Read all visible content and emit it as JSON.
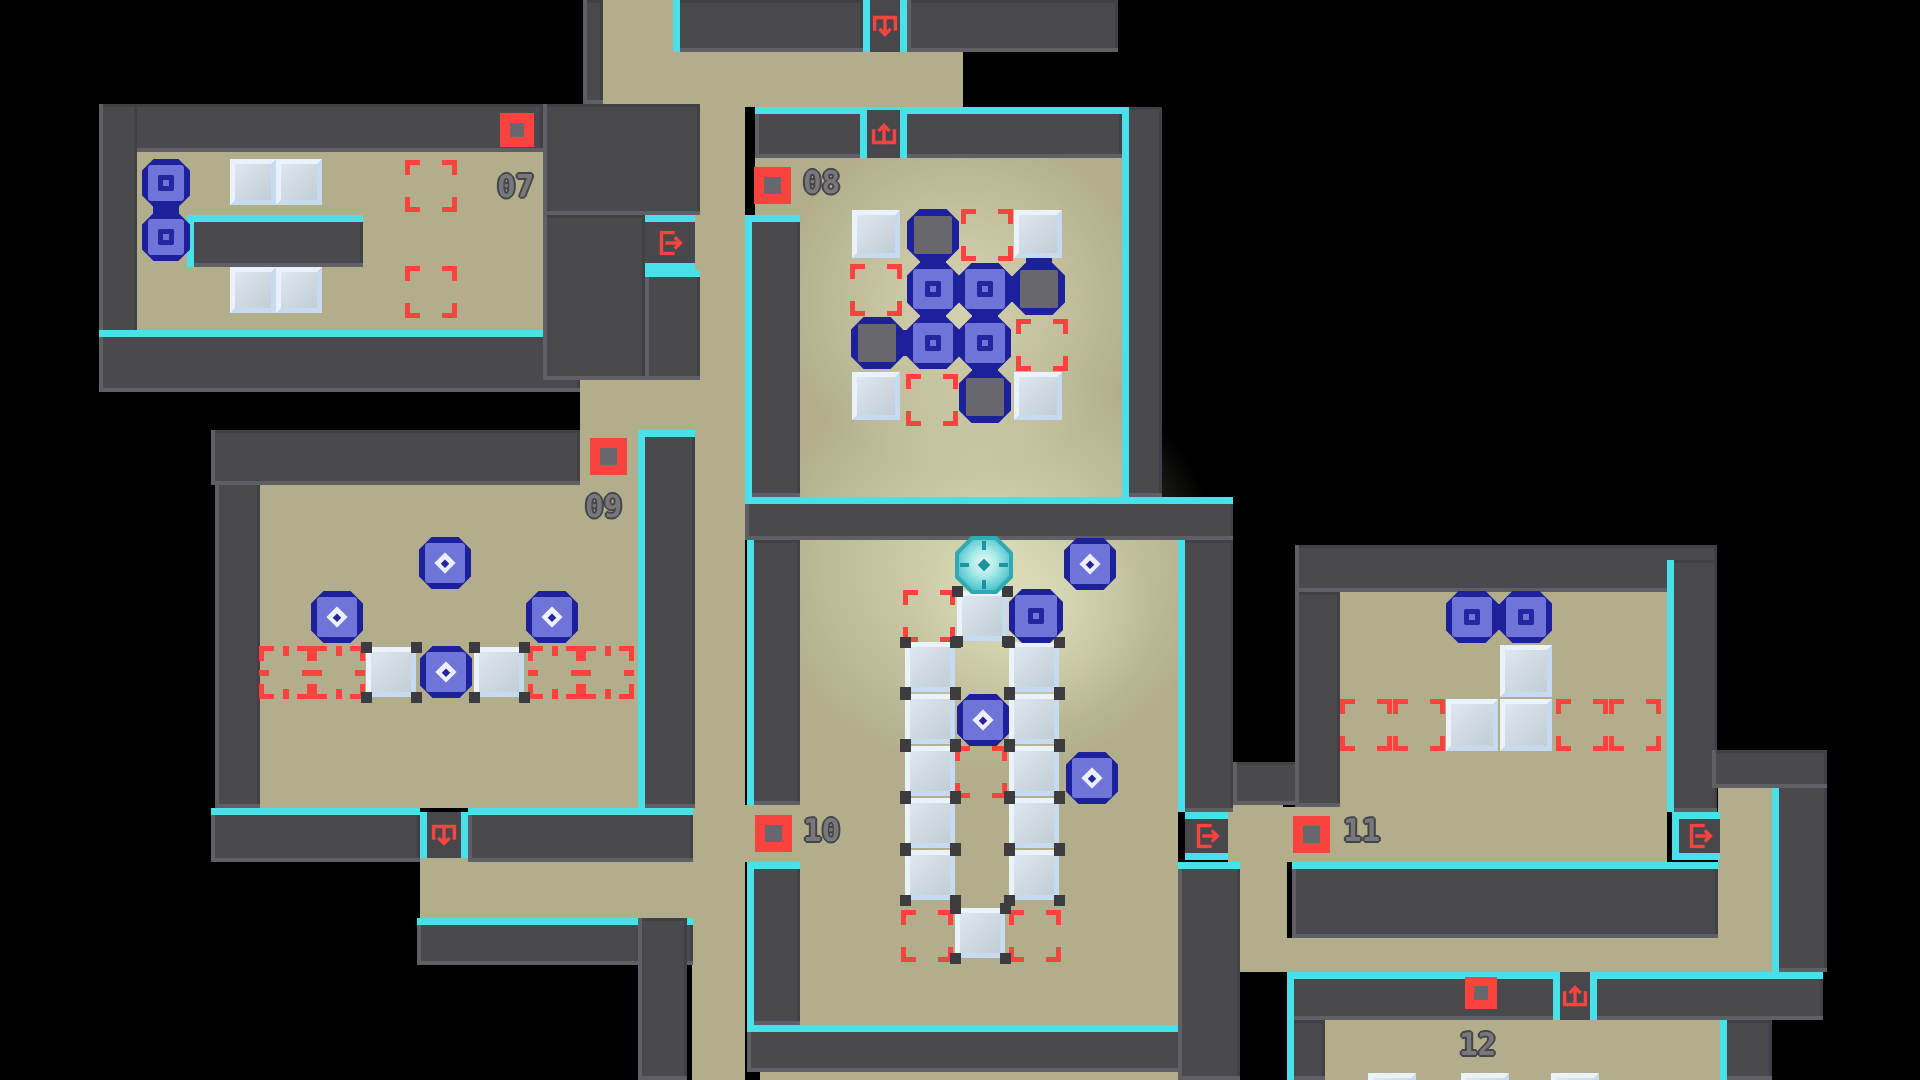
{
  "scene": {
    "kind": "puzzle-level-map",
    "visible_room_numbers": [
      "07",
      "08",
      "09",
      "10",
      "11",
      "12"
    ]
  },
  "colors": {
    "background": "#000000",
    "floor": "#b2ae8b",
    "wall": "#4a4a4e",
    "trim_cyan": "#4ae0ea",
    "accent_red": "#f8433f",
    "token_navy": "#1d209b",
    "token_fill": "#6e74d8",
    "box_light": "#eaf3fb",
    "box_face": "#ccd7de",
    "label_gray": "#77777c",
    "player_teal": "#2fa9b2"
  },
  "rooms": [
    {
      "id": "07",
      "label": "07",
      "label_pos": [
        497,
        172
      ],
      "button_pos": [
        500,
        113,
        34
      ]
    },
    {
      "id": "08",
      "label": "08",
      "label_pos": [
        803,
        168
      ],
      "button_pos": [
        754,
        167,
        37
      ]
    },
    {
      "id": "09",
      "label": "09",
      "label_pos": [
        585,
        492
      ],
      "button_pos": [
        590,
        438,
        37
      ]
    },
    {
      "id": "10",
      "label": "10",
      "label_pos": [
        803,
        816
      ],
      "button_pos": [
        755,
        815,
        37
      ]
    },
    {
      "id": "11",
      "label": "11",
      "label_pos": [
        1343,
        816
      ],
      "button_pos": [
        1293,
        816,
        37
      ]
    },
    {
      "id": "12",
      "label": "12",
      "label_pos": [
        1459,
        1030
      ],
      "button_pos": [
        1465,
        977,
        32
      ]
    }
  ],
  "map": {
    "floors": [
      [
        137,
        152,
        406,
        178
      ],
      [
        603,
        0,
        70,
        104
      ],
      [
        603,
        52,
        360,
        55
      ],
      [
        692,
        107,
        53,
        973
      ],
      [
        800,
        158,
        322,
        339
      ],
      [
        755,
        158,
        45,
        57
      ],
      [
        580,
        380,
        115,
        50
      ],
      [
        260,
        485,
        378,
        323
      ],
      [
        580,
        430,
        58,
        55
      ],
      [
        420,
        858,
        273,
        60
      ],
      [
        800,
        540,
        378,
        485
      ],
      [
        745,
        805,
        55,
        57
      ],
      [
        760,
        1072,
        430,
        8
      ],
      [
        1228,
        805,
        55,
        57
      ],
      [
        1240,
        862,
        47,
        110
      ],
      [
        1240,
        938,
        580,
        34
      ],
      [
        1340,
        592,
        327,
        215
      ],
      [
        1283,
        807,
        384,
        55
      ],
      [
        1718,
        788,
        54,
        184
      ],
      [
        1325,
        1020,
        395,
        60
      ]
    ],
    "glows": [
      [
        990,
        565,
        230,
        210,
        0.55
      ],
      [
        1035,
        618,
        120,
        110,
        0.35
      ],
      [
        962,
        300,
        185,
        175,
        0.5
      ]
    ],
    "walls": [
      [
        99,
        104,
        444,
        48,
        ""
      ],
      [
        99,
        104,
        38,
        288,
        ""
      ],
      [
        99,
        330,
        481,
        62,
        "t"
      ],
      [
        543,
        104,
        157,
        111,
        ""
      ],
      [
        543,
        215,
        102,
        165,
        ""
      ],
      [
        645,
        270,
        55,
        110,
        "t"
      ],
      [
        583,
        0,
        20,
        104,
        ""
      ],
      [
        673,
        0,
        190,
        52,
        "l"
      ],
      [
        907,
        0,
        211,
        52,
        ""
      ],
      [
        745,
        215,
        55,
        282,
        "tl"
      ],
      [
        755,
        107,
        367,
        51,
        "t"
      ],
      [
        1122,
        107,
        40,
        390,
        "l"
      ],
      [
        745,
        497,
        488,
        43,
        "t"
      ],
      [
        747,
        540,
        53,
        265,
        "l"
      ],
      [
        747,
        862,
        53,
        163,
        "tl"
      ],
      [
        747,
        1025,
        443,
        47,
        "t"
      ],
      [
        1178,
        540,
        55,
        272,
        "l"
      ],
      [
        1178,
        862,
        62,
        218,
        "t"
      ],
      [
        1233,
        762,
        107,
        43,
        ""
      ],
      [
        1295,
        545,
        422,
        47,
        ""
      ],
      [
        1295,
        592,
        45,
        215,
        ""
      ],
      [
        1667,
        560,
        50,
        252,
        "l"
      ],
      [
        1292,
        862,
        426,
        76,
        "t"
      ],
      [
        1287,
        972,
        536,
        48,
        "tl"
      ],
      [
        1287,
        1020,
        38,
        60,
        "l"
      ],
      [
        1772,
        780,
        55,
        192,
        "l"
      ],
      [
        1712,
        750,
        115,
        38,
        ""
      ],
      [
        417,
        918,
        276,
        47,
        "t"
      ],
      [
        211,
        808,
        209,
        54,
        "t"
      ],
      [
        468,
        808,
        225,
        54,
        "t"
      ],
      [
        215,
        430,
        45,
        378,
        ""
      ],
      [
        211,
        430,
        369,
        55,
        ""
      ],
      [
        638,
        430,
        57,
        378,
        "tl"
      ],
      [
        638,
        918,
        49,
        162,
        ""
      ],
      [
        187,
        215,
        176,
        52,
        "tl"
      ],
      [
        1720,
        1020,
        52,
        60,
        "l"
      ]
    ],
    "niches": [
      [
        547,
        112,
        36,
        98
      ]
    ],
    "doors": [
      [
        645,
        215,
        50,
        55,
        "right",
        "tb"
      ],
      [
        863,
        0,
        44,
        52,
        "down",
        "lr"
      ],
      [
        860,
        110,
        47,
        48,
        "up",
        "lr"
      ],
      [
        420,
        812,
        48,
        46,
        "down",
        "lr"
      ],
      [
        1185,
        812,
        43,
        48,
        "right",
        "tb"
      ],
      [
        1672,
        812,
        48,
        48,
        "right",
        "tbl"
      ],
      [
        1553,
        972,
        44,
        48,
        "up",
        "lr"
      ]
    ],
    "targets": [
      [
        405,
        160,
        52,
        "c"
      ],
      [
        405,
        266,
        52,
        "c"
      ],
      [
        961,
        209,
        52,
        "c"
      ],
      [
        850,
        264,
        52,
        "c"
      ],
      [
        1016,
        319,
        52,
        "c"
      ],
      [
        906,
        374,
        52,
        "c"
      ],
      [
        259,
        646,
        53,
        "t"
      ],
      [
        312,
        646,
        53,
        "t"
      ],
      [
        528,
        646,
        53,
        "t"
      ],
      [
        581,
        646,
        53,
        "t"
      ],
      [
        903,
        590,
        52,
        "c"
      ],
      [
        955,
        746,
        52,
        "c"
      ],
      [
        901,
        910,
        52,
        "c"
      ],
      [
        1009,
        910,
        52,
        "c"
      ],
      [
        1340,
        699,
        52,
        "c"
      ],
      [
        1393,
        699,
        52,
        "c"
      ],
      [
        1556,
        699,
        52,
        "c"
      ],
      [
        1609,
        699,
        52,
        "c"
      ]
    ],
    "boxes": [
      [
        230,
        159,
        46,
        0
      ],
      [
        276,
        159,
        46,
        0
      ],
      [
        230,
        267,
        46,
        0
      ],
      [
        276,
        267,
        46,
        0
      ],
      [
        852,
        210,
        48,
        0
      ],
      [
        1014,
        210,
        48,
        0
      ],
      [
        852,
        372,
        48,
        0
      ],
      [
        1014,
        372,
        48,
        0
      ],
      [
        366,
        647,
        50,
        1
      ],
      [
        474,
        647,
        50,
        1
      ],
      [
        957,
        591,
        50,
        1
      ],
      [
        905,
        642,
        50,
        1
      ],
      [
        1009,
        642,
        50,
        1
      ],
      [
        905,
        694,
        50,
        1
      ],
      [
        1009,
        694,
        50,
        1
      ],
      [
        905,
        746,
        50,
        1
      ],
      [
        1009,
        746,
        50,
        1
      ],
      [
        905,
        798,
        50,
        1
      ],
      [
        1009,
        798,
        50,
        1
      ],
      [
        905,
        850,
        50,
        1
      ],
      [
        1009,
        850,
        50,
        1
      ],
      [
        955,
        908,
        50,
        1
      ],
      [
        1500,
        645,
        52,
        0
      ],
      [
        1446,
        699,
        52,
        0
      ],
      [
        1500,
        699,
        52,
        0
      ],
      [
        1368,
        1073,
        48,
        0
      ],
      [
        1461,
        1073,
        48,
        0
      ],
      [
        1551,
        1073,
        48,
        0
      ]
    ],
    "blobs": [
      [
        907,
        209,
        52
      ],
      [
        1013,
        263,
        52
      ],
      [
        851,
        317,
        52
      ],
      [
        959,
        371,
        52
      ]
    ],
    "tokens": [
      [
        142,
        159,
        48,
        "sq"
      ],
      [
        142,
        213,
        48,
        "sq"
      ],
      [
        907,
        263,
        52,
        "sq"
      ],
      [
        959,
        263,
        52,
        "sq"
      ],
      [
        907,
        317,
        52,
        "sq"
      ],
      [
        959,
        317,
        52,
        "sq"
      ],
      [
        419,
        537,
        52,
        "dia"
      ],
      [
        311,
        591,
        52,
        "dia"
      ],
      [
        526,
        591,
        52,
        "dia"
      ],
      [
        420,
        646,
        52,
        "dia"
      ],
      [
        1064,
        538,
        52,
        "dia"
      ],
      [
        1009,
        589,
        54,
        "sq"
      ],
      [
        957,
        694,
        52,
        "dia"
      ],
      [
        1066,
        752,
        52,
        "dia"
      ],
      [
        1446,
        591,
        52,
        "sq"
      ],
      [
        1500,
        591,
        52,
        "sq"
      ]
    ],
    "bridges": [
      [
        166,
        183,
        166,
        237
      ],
      [
        933,
        235,
        933,
        289
      ],
      [
        933,
        289,
        985,
        289
      ],
      [
        985,
        289,
        1039,
        289
      ],
      [
        1039,
        289,
        1039,
        235
      ],
      [
        877,
        343,
        933,
        343
      ],
      [
        933,
        343,
        985,
        343
      ],
      [
        933,
        289,
        933,
        343
      ],
      [
        985,
        289,
        985,
        343
      ],
      [
        985,
        343,
        985,
        397
      ],
      [
        1472,
        617,
        1526,
        617
      ]
    ],
    "player": [
      955,
      536,
      58
    ]
  }
}
